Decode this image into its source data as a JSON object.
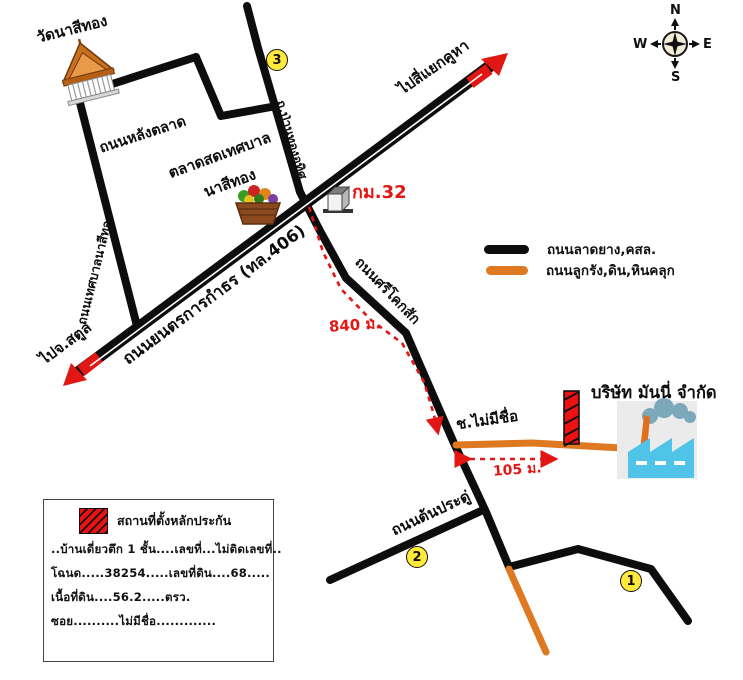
{
  "landmarks": {
    "temple": "วัดนาสีทอง",
    "market_line1": "ตลาดสดเทศบาล",
    "market_line2": "นาสีทอง",
    "km_marker": "กม.32",
    "company": "บริษัท มันนี่ จำกัด"
  },
  "roads": {
    "main": "ถนนยนตรการกำธร (ทล.406)",
    "back_market": "ถนนหลังตลาด",
    "municipal": "ถนนเทศบาลนาสีทอง",
    "pan_thong": "ถ.ป่านทองอุทิศ",
    "sri_khok_sak": "ถนนศรีโคกสัก",
    "ton_pradu": "ถนนต้นประดู่",
    "soi_no_name": "ช.ไม่มีชื่อ"
  },
  "directions": {
    "to_satun": "ไปจ.สตูล",
    "to_khuha": "ไปสี่แยกคูหา"
  },
  "distances": {
    "d840": "840 ม.",
    "d105": "105 ม."
  },
  "legend": {
    "paved_label": "ถนนลาดยาง,คสล.",
    "gravel_label": "ถนนลูกรัง,ดิน,หินคลุก",
    "paved_color": "#0d0d0d",
    "gravel_color": "#de7921"
  },
  "markers": {
    "point1": "1",
    "point2": "2",
    "point3": "3"
  },
  "compass": {
    "n": "N",
    "e": "E",
    "s": "S",
    "w": "W"
  },
  "info_box": {
    "legend_label": "สถานที่ตั้งหลักประกัน",
    "line1": "..บ้านเดี่ยวตึก 1 ชั้น....เลขที่...ไม่ติดเลขที่..",
    "line2": "โฉนด.....38254.....เลขที่ดิน....68.....",
    "line3": "เนื้อที่ดิน....56.2.....ตรว.",
    "line4": "ซอย..........ไม่มีชื่อ............."
  },
  "colors": {
    "road_black": "#0d0d0d",
    "road_orange": "#de7921",
    "accent_red": "#e21613",
    "marker_yellow": "#ffe93b",
    "factory_blue": "#4fc3e8",
    "smoke_gray": "#7ba8ba"
  }
}
